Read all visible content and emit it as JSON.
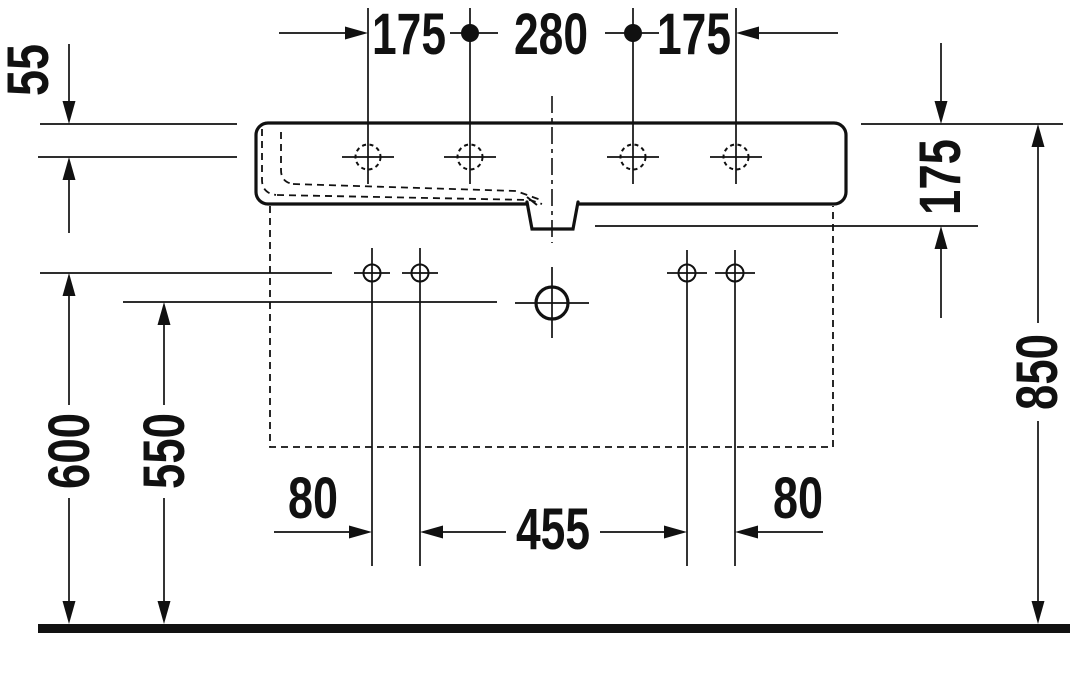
{
  "colors": {
    "ink": "#111111",
    "background": "#ffffff"
  },
  "dimensions": {
    "tap_hole_left": "175",
    "tap_hole_center": "280",
    "tap_hole_right": "175",
    "front_edge": "55",
    "rim_to_outlet": "175",
    "overall_height": "850",
    "rim_height": "600",
    "drain_center_height": "550",
    "bolt_left_spacing": "80",
    "bolt_center_span": "455",
    "bolt_right_spacing": "80"
  }
}
